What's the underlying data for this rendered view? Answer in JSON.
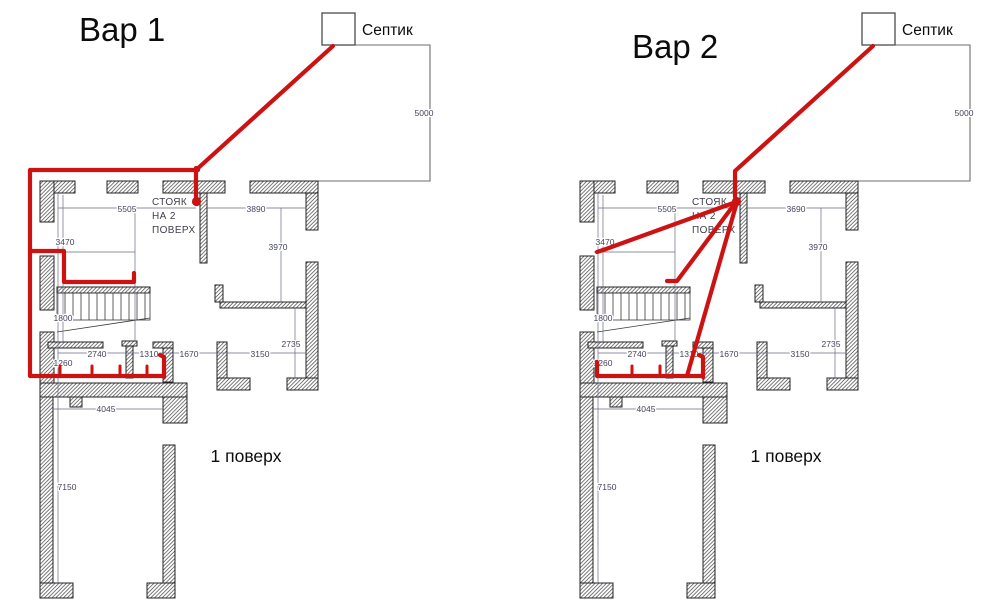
{
  "labels": {
    "septic": "Септик",
    "riser_line1": "СТОЯК",
    "riser_line2": "НА 2",
    "riser_line3": "ПОВЕРХ",
    "floor": "1 поверх"
  },
  "dimensions": {
    "septic_line": "5000",
    "top_left": "5505",
    "left_width": "3470",
    "right_room": "3970",
    "stairs": "1800",
    "chain_1": "2740",
    "chain_2": "1310",
    "chain_3": "1670",
    "chain_4": "3150",
    "right_lower": "2735",
    "bath": "1260",
    "porch": "4045",
    "terrace": "7150"
  },
  "colors": {
    "pipe": "#cd1212",
    "walls": "#232323",
    "dimension_text": "#44445e"
  },
  "variants": [
    {
      "title": "Вар 1",
      "dim_top_right": "3890",
      "pipes": [
        {
          "name": "pipe-septic-to-corner",
          "points": [
            [
              333,
              46
            ],
            [
              196,
              170
            ]
          ]
        },
        {
          "name": "pipe-riser-drop",
          "points": [
            [
              196,
              168
            ],
            [
              196,
              197
            ]
          ]
        },
        {
          "name": "pipe-outer-route",
          "points": [
            [
              198,
              170
            ],
            [
              30,
              170
            ],
            [
              30,
              376
            ],
            [
              164,
              376
            ]
          ]
        },
        {
          "name": "pipe-end-stub",
          "points": [
            [
              164,
              377
            ],
            [
              164,
              357
            ],
            [
              160,
              355
            ]
          ]
        },
        {
          "name": "pipe-kitchen-branch",
          "points": [
            [
              30,
              251
            ],
            [
              64,
              251
            ],
            [
              64,
              282
            ],
            [
              134,
              282
            ],
            [
              134,
              273
            ]
          ]
        },
        {
          "name": "pipe-fixture-hook",
          "thin": true,
          "points": [
            [
              60,
              375
            ],
            [
              60,
              366
            ]
          ]
        },
        {
          "name": "pipe-fixture-hook",
          "thin": true,
          "points": [
            [
              92,
              375
            ],
            [
              92,
              366
            ]
          ]
        },
        {
          "name": "pipe-fixture-hook",
          "thin": true,
          "points": [
            [
              120,
              375
            ],
            [
              120,
              366
            ]
          ]
        },
        {
          "name": "pipe-fixture-hook",
          "thin": true,
          "points": [
            [
              147,
              375
            ],
            [
              147,
              366
            ]
          ]
        },
        {
          "name": "riser-outlet-dot",
          "dot": [
            196.5,
            201.5
          ]
        }
      ]
    },
    {
      "title": "Вар 2",
      "dim_top_right": "3690",
      "pipes": [
        {
          "name": "pipe-septic-to-riser",
          "points": [
            [
              873,
              46
            ],
            [
              735,
              171
            ],
            [
              735,
              197
            ]
          ]
        },
        {
          "name": "pipe-branch-left",
          "points": [
            [
              736,
              202
            ],
            [
              606,
              249
            ],
            [
              597,
              252
            ]
          ]
        },
        {
          "name": "pipe-branch-middle",
          "points": [
            [
              736,
              202
            ],
            [
              677,
              281
            ],
            [
              667,
              281
            ]
          ]
        },
        {
          "name": "pipe-branch-bottom",
          "points": [
            [
              737,
              202
            ],
            [
              687,
              376
            ]
          ]
        },
        {
          "name": "pipe-bottom-run",
          "points": [
            [
              597,
              362
            ],
            [
              597,
              376
            ],
            [
              703,
              376
            ]
          ]
        },
        {
          "name": "pipe-end-stub",
          "points": [
            [
              703,
              377
            ],
            [
              703,
              357
            ],
            [
              699,
              355
            ]
          ]
        },
        {
          "name": "pipe-fixture-hook",
          "thin": true,
          "points": [
            [
              632,
              375
            ],
            [
              632,
              366
            ]
          ]
        },
        {
          "name": "pipe-fixture-hook",
          "thin": true,
          "points": [
            [
              660,
              375
            ],
            [
              660,
              366
            ]
          ]
        },
        {
          "name": "riser-outlet-dot",
          "dot": [
            736.5,
            201.5
          ]
        }
      ]
    }
  ]
}
